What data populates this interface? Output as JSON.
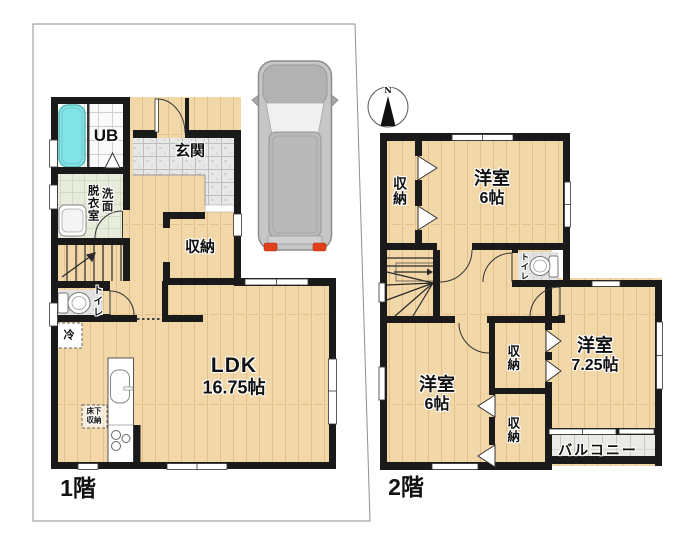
{
  "colors": {
    "wall": "#1a1a1a",
    "wood_floor": "#f2d7a8",
    "entrance_tile": "#e7e7e7",
    "bath_tub": "#82e4e6",
    "washroom_floor": "#e7ecdc",
    "balcony_floor": "#eaeae6",
    "car_body": "#c6c6c6",
    "taillight": "#e2401c",
    "boundary_line": "#909090"
  },
  "floor1": {
    "label": "1階",
    "unit_bath": "UB",
    "entrance": "玄関",
    "dressing_room": "脱衣室",
    "washroom": "洗面",
    "storage": "収納",
    "toilet": "トイレ",
    "fridge": "冷",
    "underfloor_storage_line1": "床下",
    "underfloor_storage_line2": "収納",
    "ldk_line1": "LDK",
    "ldk_line2": "16.75帖"
  },
  "floor2": {
    "label": "2階",
    "compass_north": "N",
    "closet_top": "収納",
    "bedroom_top_line1": "洋室",
    "bedroom_top_line2": "6帖",
    "toilet": "トイレ",
    "closet_mid": "収納",
    "closet_low": "収納",
    "bedroom_left_line1": "洋室",
    "bedroom_left_line2": "6帖",
    "bedroom_right_line1": "洋室",
    "bedroom_right_line2": "7.25帖",
    "balcony": "バルコニー"
  }
}
